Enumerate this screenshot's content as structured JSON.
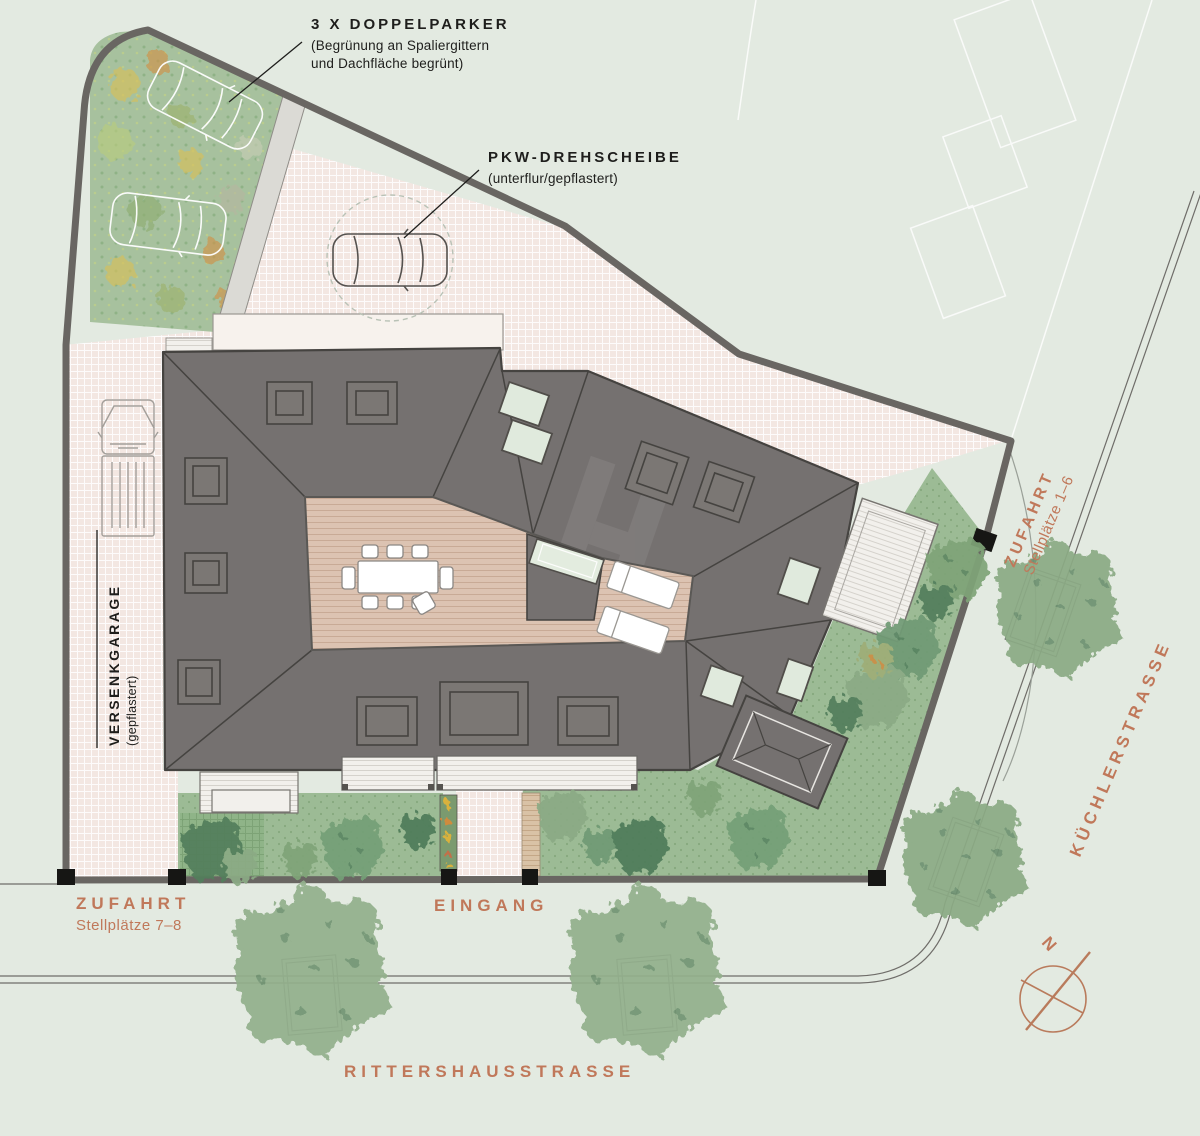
{
  "labels": {
    "doppelparker": {
      "title": "3 X DOPPELPARKER",
      "sub1": "(Begrünung an Spaliergittern",
      "sub2": "und Dachfläche begrünt)"
    },
    "drehscheibe": {
      "title": "PKW-DREHSCHEIBE",
      "sub": "(unterflur/gepflastert)"
    },
    "versenkgarage": {
      "title": "VERSENKGARAGE",
      "sub": "(gepflastert)"
    },
    "zufahrt_ost": {
      "title": "ZUFAHRT",
      "sub": "Stellplätze 1–6"
    },
    "zufahrt_sued": {
      "title": "ZUFAHRT",
      "sub": "Stellplätze 7–8"
    },
    "eingang": {
      "title": "EINGANG"
    },
    "streets": {
      "kuechlerstrasse": "KÜCHLERSTRASSE",
      "rittershausstrasse": "RITTERSHAUSSTRASSE"
    },
    "north": "N"
  },
  "colors": {
    "background": "#e3eae1",
    "paving_pink": "#f3e7e2",
    "paving_grid": "#ffffff",
    "roof_gray": "#757170",
    "roof_line": "#454340",
    "boundary_gray": "#696662",
    "deck_tan": "#dcc3b2",
    "lawn_green": "#9cbb95",
    "green_roof": "#a7c19e",
    "tree_light": "#92af8b",
    "tree_dark": "#527e5c",
    "skylight_green": "#e0eadd",
    "slats_white": "#f2f0ec",
    "accent_text": "#c0785a",
    "label_text": "#1e1e1c"
  }
}
